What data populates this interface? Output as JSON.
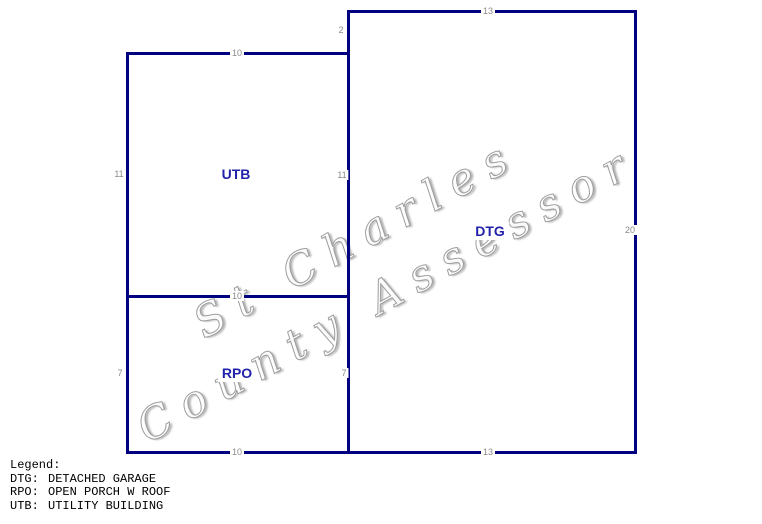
{
  "sketch": {
    "labels": {
      "dtg": "DTG",
      "utb": "UTB",
      "rpo": "RPO"
    },
    "dimensions": {
      "utb_top": "10",
      "utb_left": "11",
      "utb_right": "11",
      "utb_rpo_divider": "10",
      "rpo_left": "7",
      "rpo_right": "7",
      "rpo_bottom": "10",
      "dtg_top": "13",
      "dtg_left_upper": "2",
      "dtg_right": "20",
      "dtg_bottom": "13"
    }
  },
  "watermark": {
    "line1": "St Charles",
    "line2": "County Assessor"
  },
  "legend": {
    "title": "Legend:",
    "entries": [
      {
        "code": "DTG:",
        "desc": "DETACHED GARAGE"
      },
      {
        "code": "RPO:",
        "desc": "OPEN PORCH W ROOF"
      },
      {
        "code": "UTB:",
        "desc": "UTILITY BUILDING"
      }
    ]
  },
  "colors": {
    "outline": "#000080",
    "building_label": "#2222aa",
    "dimension_text": "#8a8a8a",
    "watermark_text": "#9d9d9d",
    "legend_text": "#000000",
    "background": "#ffffff"
  }
}
